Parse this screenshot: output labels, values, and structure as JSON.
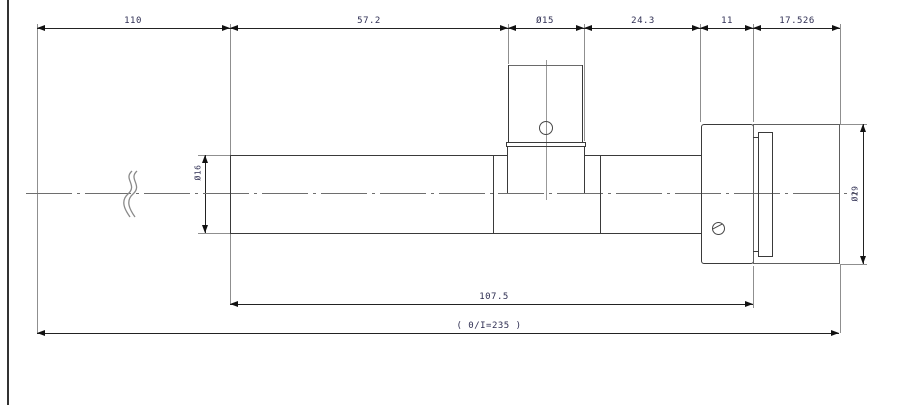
{
  "drawing": {
    "title": "shaft-assembly-dimension-drawing",
    "dims": {
      "top": [
        "110",
        "57.2",
        "Ø15",
        "24.3",
        "11",
        "17.526"
      ],
      "bottom": [
        "107.5",
        "( 0/I=235 )"
      ],
      "left_diameter": "Ø16",
      "right_diameter": "Ø29"
    },
    "symbols": {
      "break": "pipe-break-squiggle-icon",
      "boss_hole": "boss-center-hole",
      "flange_screw": "flange-screw-hole"
    },
    "colors": {
      "background": "#ffffff",
      "part_line": "#3a3a3a",
      "dimension_line": "#222222",
      "extension_line": "#8f8f8f",
      "text": "#2e2e52",
      "frame": "#333333"
    }
  }
}
